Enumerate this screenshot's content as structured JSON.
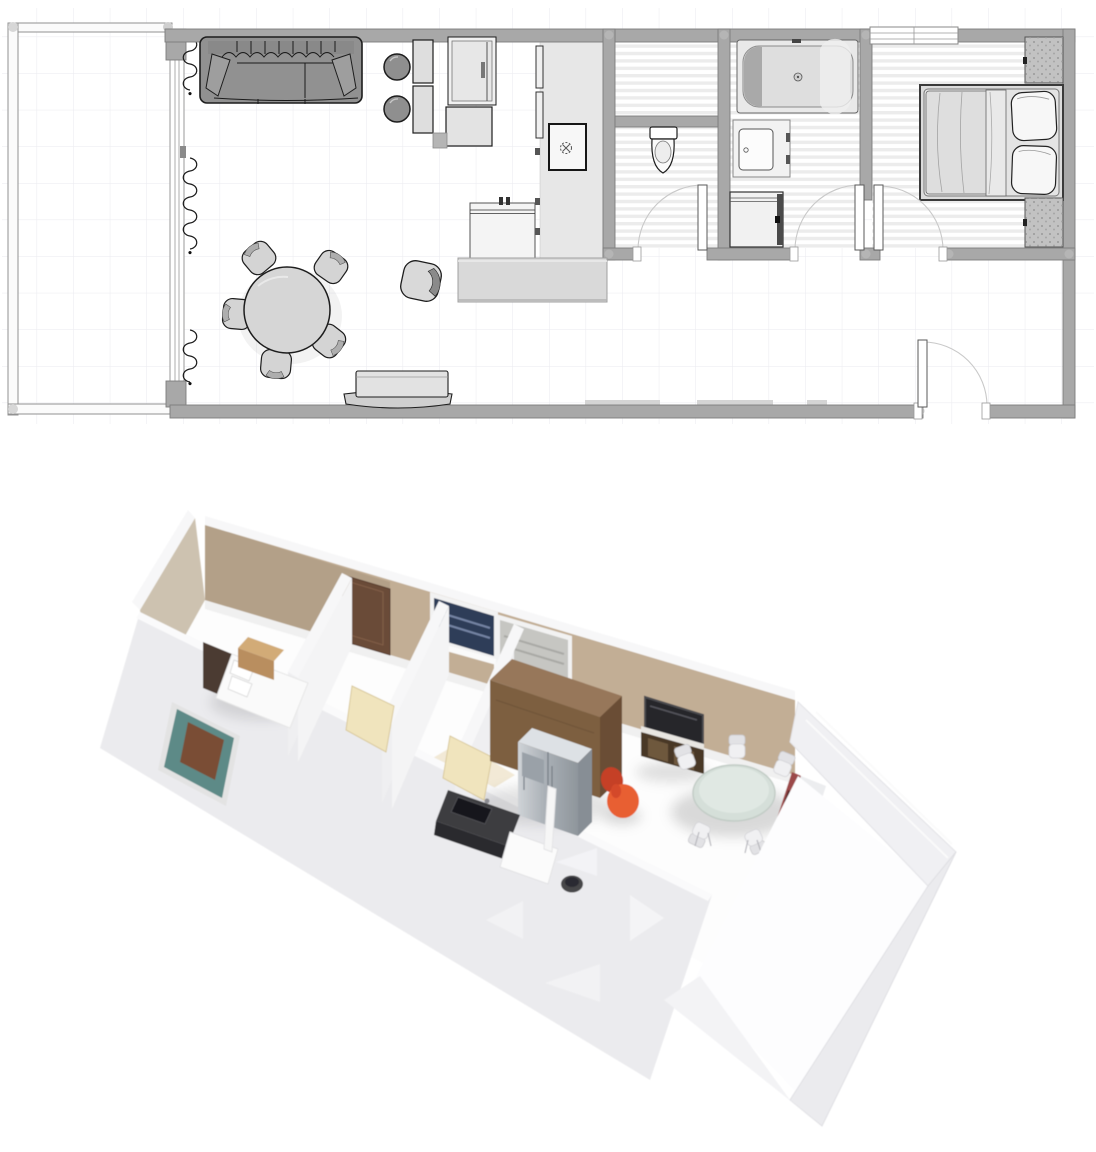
{
  "app": {
    "description": "Floor planner canvas with a 2D top-down plan above and a 3D dollhouse render below",
    "visible_text": "none"
  },
  "floor_plan": {
    "view": "2D top-down plan",
    "rooms": [
      {
        "id": "balcony",
        "label": "Balcony / terrace",
        "floor": "grid"
      },
      {
        "id": "living-dining",
        "label": "Open living / dining area",
        "floor": "white"
      },
      {
        "id": "kitchen",
        "label": "Kitchen strip",
        "floor": "light-gray"
      },
      {
        "id": "wc",
        "label": "WC room",
        "floor": "striped-tile"
      },
      {
        "id": "bathroom",
        "label": "Bathroom",
        "floor": "striped-tile"
      },
      {
        "id": "bedroom",
        "label": "Bedroom",
        "floor": "striped-tile"
      },
      {
        "id": "entry",
        "label": "Entry area",
        "floor": "white"
      }
    ],
    "furniture": [
      "sofa",
      "bar-stool-1",
      "bar-stool-2",
      "wall-cabinet-1",
      "wall-cabinet-2",
      "fridge",
      "base-cabinet",
      "kitchen-counter",
      "cooktop-oven",
      "kitchen-sink-cabinet",
      "kitchen-island",
      "dining-table",
      "dining-chairs-x5",
      "armchair",
      "tv-bench",
      "toilet",
      "bathtub",
      "washbasin",
      "washing-machine",
      "double-bed",
      "wardrobe-top",
      "wardrobe-bottom"
    ],
    "doors": [
      "wc-door",
      "bathroom-door",
      "bedroom-door",
      "entrance-door"
    ],
    "windows": [
      "balcony-glass-wall",
      "bedroom-window",
      "living-low-windows"
    ],
    "curtain_segments": 3
  },
  "render_3d": {
    "view": "3D dollhouse render, rotated ~180° vs plan (bedroom left, balcony lower right)",
    "items": [
      "bed-with-headboard",
      "wood-dresser",
      "bedroom-window-teal",
      "dark-wood-door",
      "partition-walls",
      "open-cream-doors",
      "hall-cream-floor",
      "tall-brown-cabinet",
      "stainless-fridge",
      "dark-counter-with-sink",
      "white-base-cabinet",
      "floor-lamp-pole",
      "trash-bin",
      "wall-windows-strip",
      "tv-flatscreen",
      "media-console",
      "orange-armchair",
      "round-dining-table",
      "dining-chairs-x6",
      "red-curtain-wall",
      "balcony-walls",
      "navigation-arrows-x4"
    ],
    "nav_arrow_count": 4
  },
  "colors": {
    "plan_wall": "#a8a8a8",
    "wall_tan_light": "#c2ae95",
    "wall_tan_dark": "#b3a088",
    "end_wall_tan": "#cdc2b0",
    "curtain_red": "#9c4a48",
    "curtain_red_dark": "#5e2a2c",
    "armchair_orange": "#e85e32",
    "armchair_orange_dark": "#c54026",
    "door_cream": "#f0e4bd",
    "floor_cream": "#f2e9d6",
    "window_teal": "#5d8a87",
    "window_navy": "#2e3c58",
    "window_gray": "#c6c6c2",
    "cabinet_brown": "#7d5f41",
    "cabinet_brown_top": "#97775150",
    "console_brown": "#4a3828",
    "tv_black": "#26262a",
    "fridge_silver": "#a9afb5"
  },
  "css_vars": {
    "--wall-fill": "#a8a8a8",
    "--wall-stroke": "#7d7d7d",
    "--grid-color": "#eaeaef",
    "--stripe-color": "#ececec",
    "--kitchen-strip": "#e7e7e7"
  }
}
